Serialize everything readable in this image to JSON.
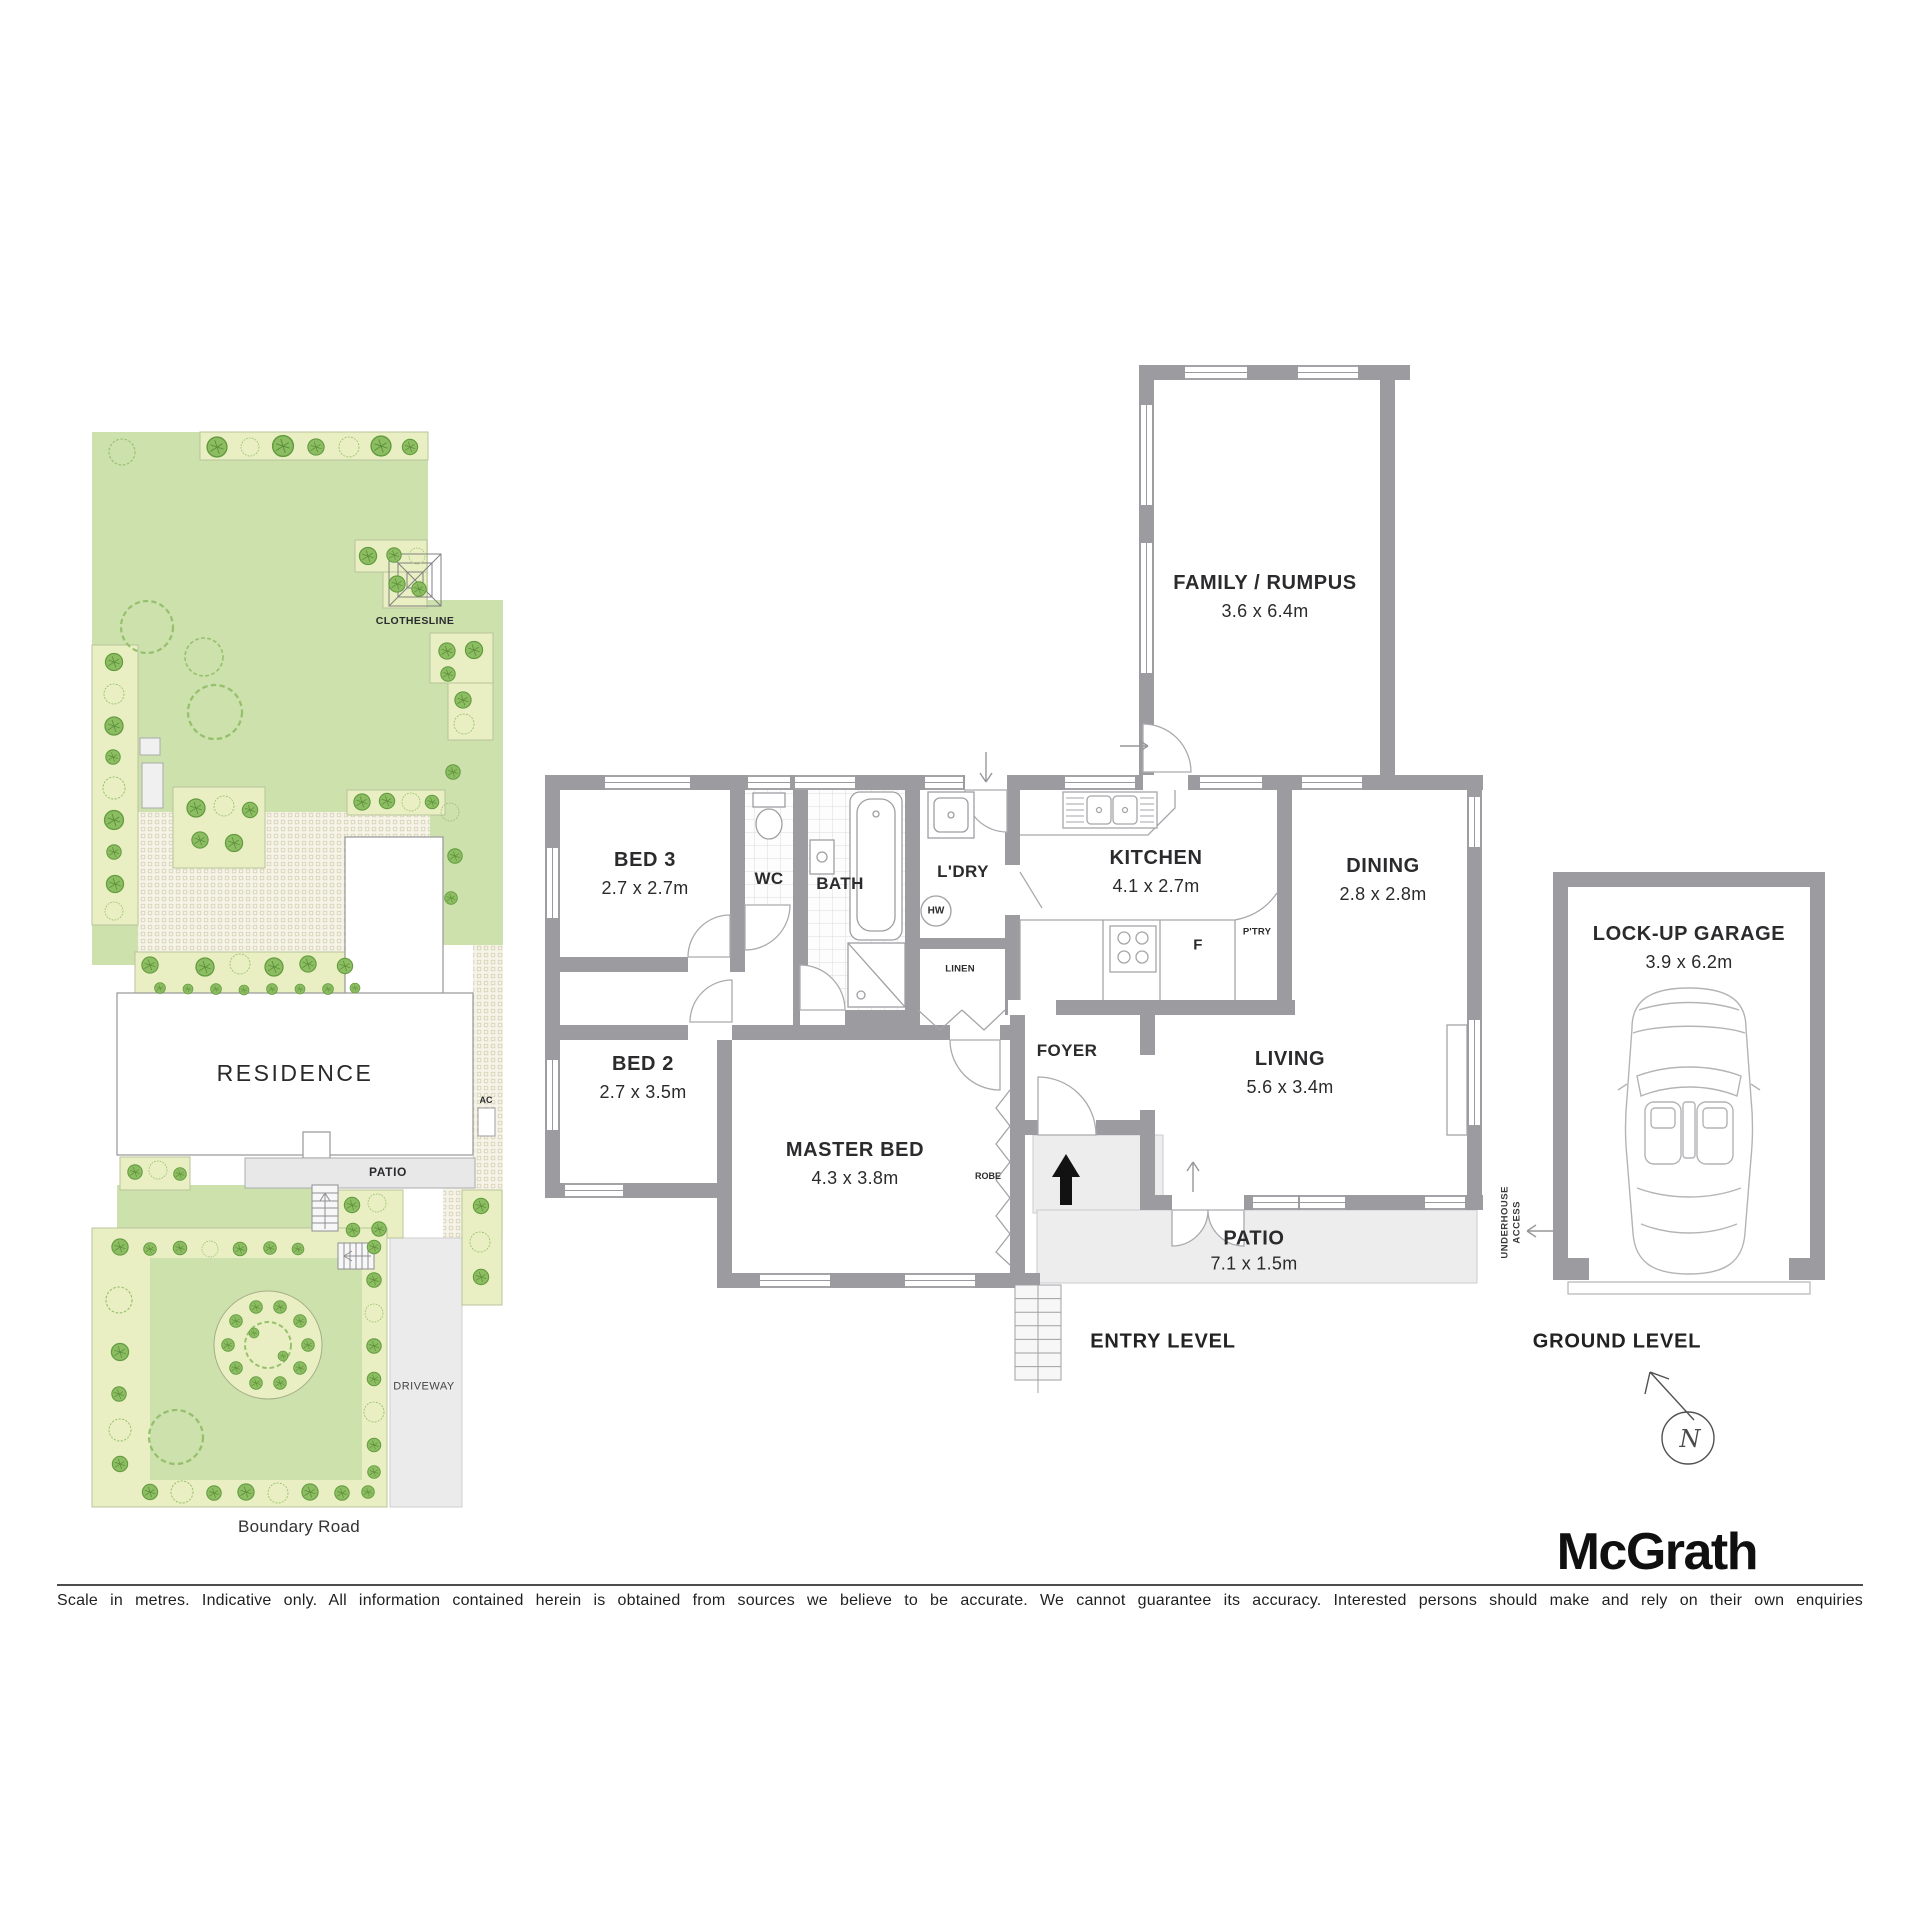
{
  "site_plan": {
    "clothesline": "CLOTHESLINE",
    "residence": "RESIDENCE",
    "patio": "PATIO",
    "ac": "AC",
    "driveway": "DRIVEWAY",
    "road": "Boundary Road"
  },
  "entry_level": {
    "level": "ENTRY LEVEL",
    "rooms": {
      "family": {
        "name": "FAMILY / RUMPUS",
        "dims": "3.6 x 6.4m"
      },
      "bed3": {
        "name": "BED 3",
        "dims": "2.7 x 2.7m"
      },
      "bed2": {
        "name": "BED 2",
        "dims": "2.7 x 3.5m"
      },
      "master": {
        "name": "MASTER BED",
        "dims": "4.3 x 3.8m"
      },
      "kitchen": {
        "name": "KITCHEN",
        "dims": "4.1 x 2.7m"
      },
      "dining": {
        "name": "DINING",
        "dims": "2.8 x 2.8m"
      },
      "living": {
        "name": "LIVING",
        "dims": "5.6 x 3.4m"
      },
      "patio": {
        "name": "PATIO",
        "dims": "7.1 x 1.5m"
      }
    },
    "labels": {
      "wc": "WC",
      "bath": "BATH",
      "laundry": "L'DRY",
      "hw": "HW",
      "linen": "LINEN",
      "fridge": "F",
      "pantry": "P'TRY",
      "foyer": "FOYER",
      "robe": "ROBE",
      "underhouse": "UNDERHOUSE ACCESS"
    }
  },
  "ground_level": {
    "level": "GROUND LEVEL",
    "garage": {
      "name": "LOCK-UP GARAGE",
      "dims": "3.9 x 6.2m"
    },
    "compass": "N"
  },
  "footer": {
    "brand": "McGrath",
    "disclaimer": "Scale in metres. Indicative only. All information contained herein is obtained from sources we believe to be accurate. We cannot guarantee its accuracy. Interested persons should make and rely on their own enquiries"
  }
}
